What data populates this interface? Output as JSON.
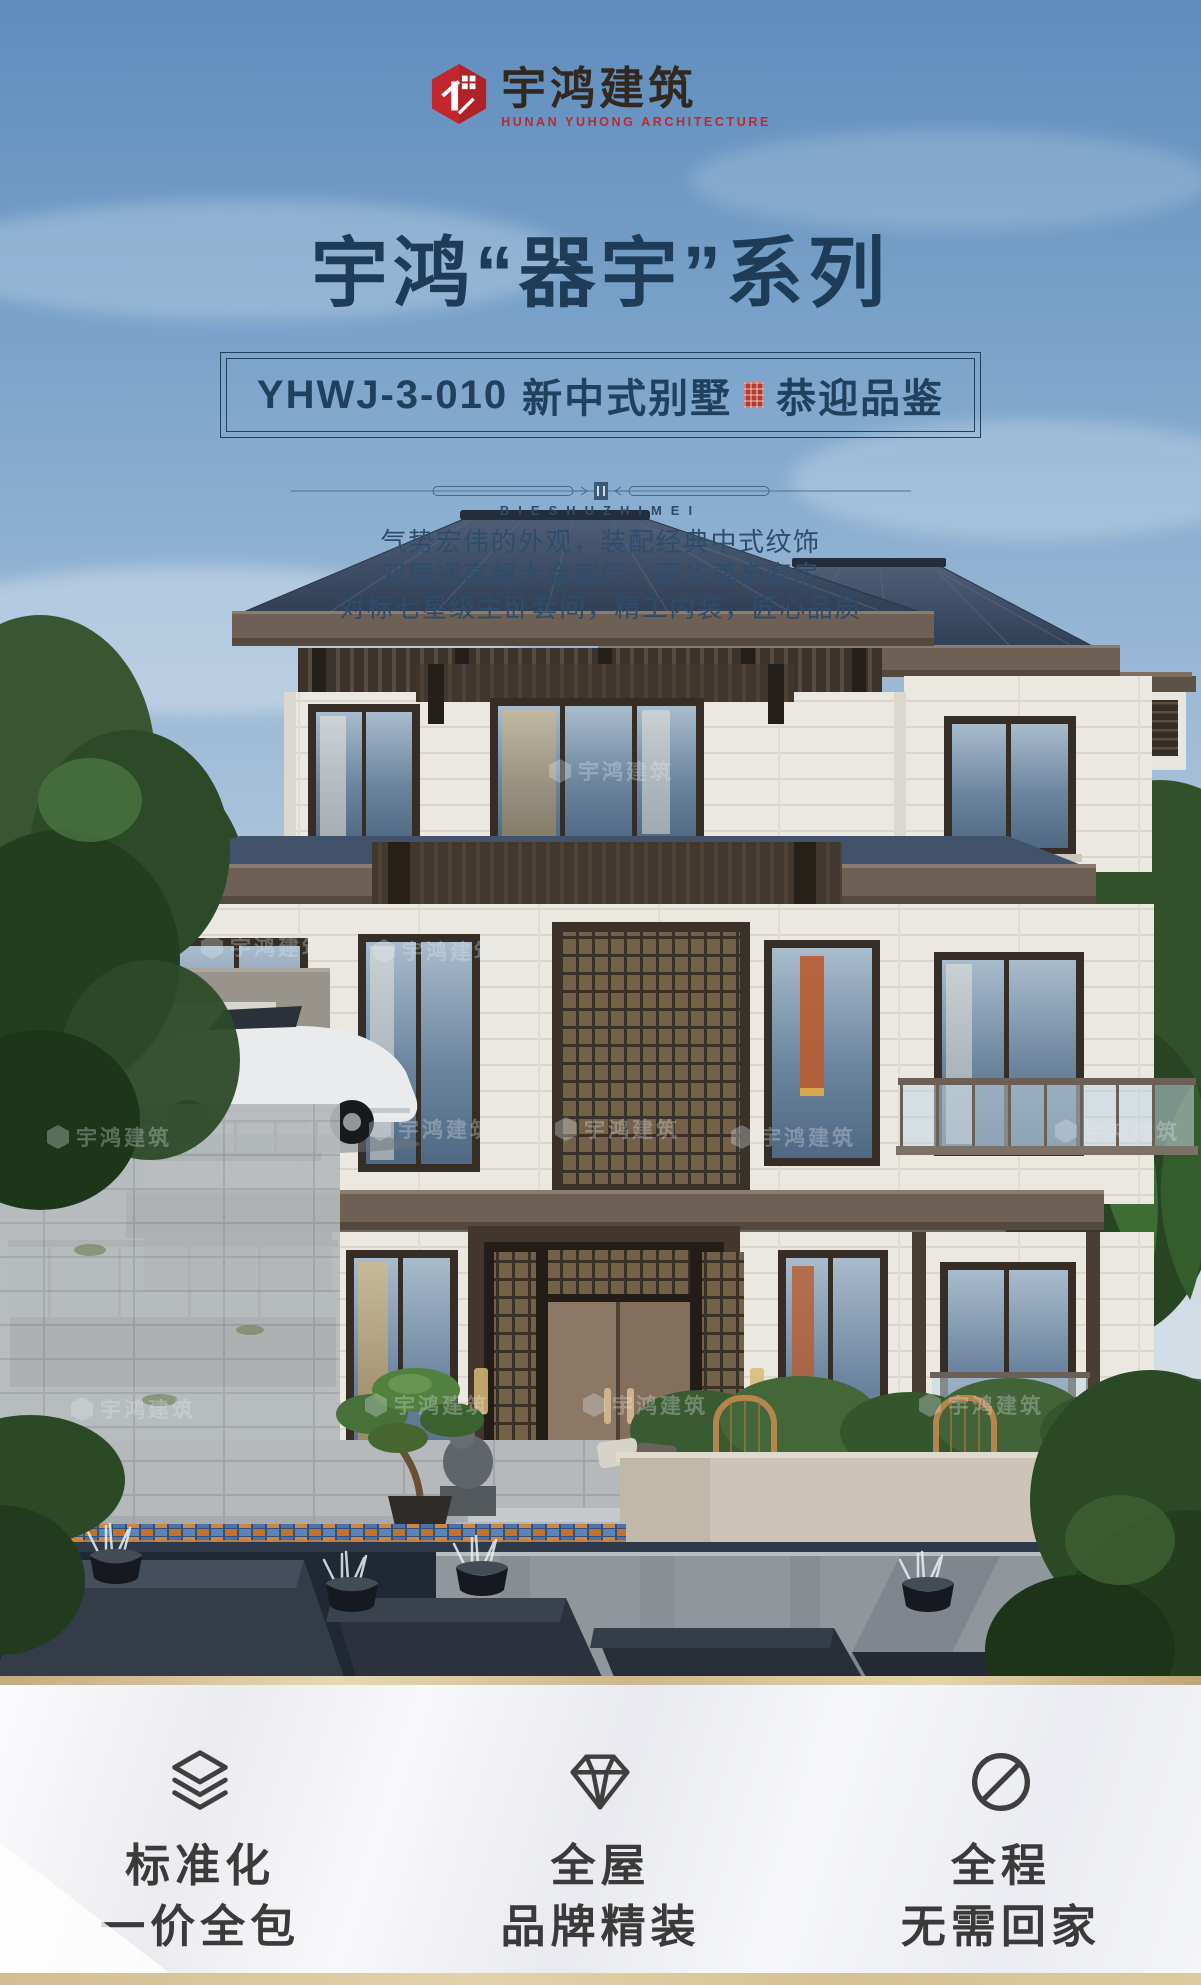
{
  "colors": {
    "brand_red": "#c1272d",
    "title_navy": "#1e3c58",
    "description_blue": "#2e4d6d",
    "gold": "#cdb488",
    "feature_text": "#3a3a3a"
  },
  "brand": {
    "logo_icon": "hexagon-building-icon",
    "name": "宇鸿建筑",
    "tagline": "HUNAN YUHONG ARCHITECTURE"
  },
  "hero": {
    "series_title": "宇鸿“器宇”系列",
    "model_code": "YHWJ-3-010",
    "model_type": "新中式别墅",
    "seal_icon": "red-seal-icon",
    "invite_text": "恭迎品鉴",
    "divider_caption": "BIESHUZHIMEI",
    "description_lines": [
      "气势宏伟的外观，装配经典中式纹饰",
      "双层通高超大会客厅，豪华尊亲套房",
      "对标七星级主卧套间，精工内装，匠心品质"
    ]
  },
  "photo": {
    "subject": "新中式三层别墅效果图",
    "watermark_text": "宇鸿建筑"
  },
  "features": [
    {
      "icon": "layers-icon",
      "title": "标准化",
      "subtitle": "一价全包"
    },
    {
      "icon": "diamond-icon",
      "title": "全屋",
      "subtitle": "品牌精装"
    },
    {
      "icon": "no-return-icon",
      "title": "全程",
      "subtitle": "无需回家"
    }
  ]
}
